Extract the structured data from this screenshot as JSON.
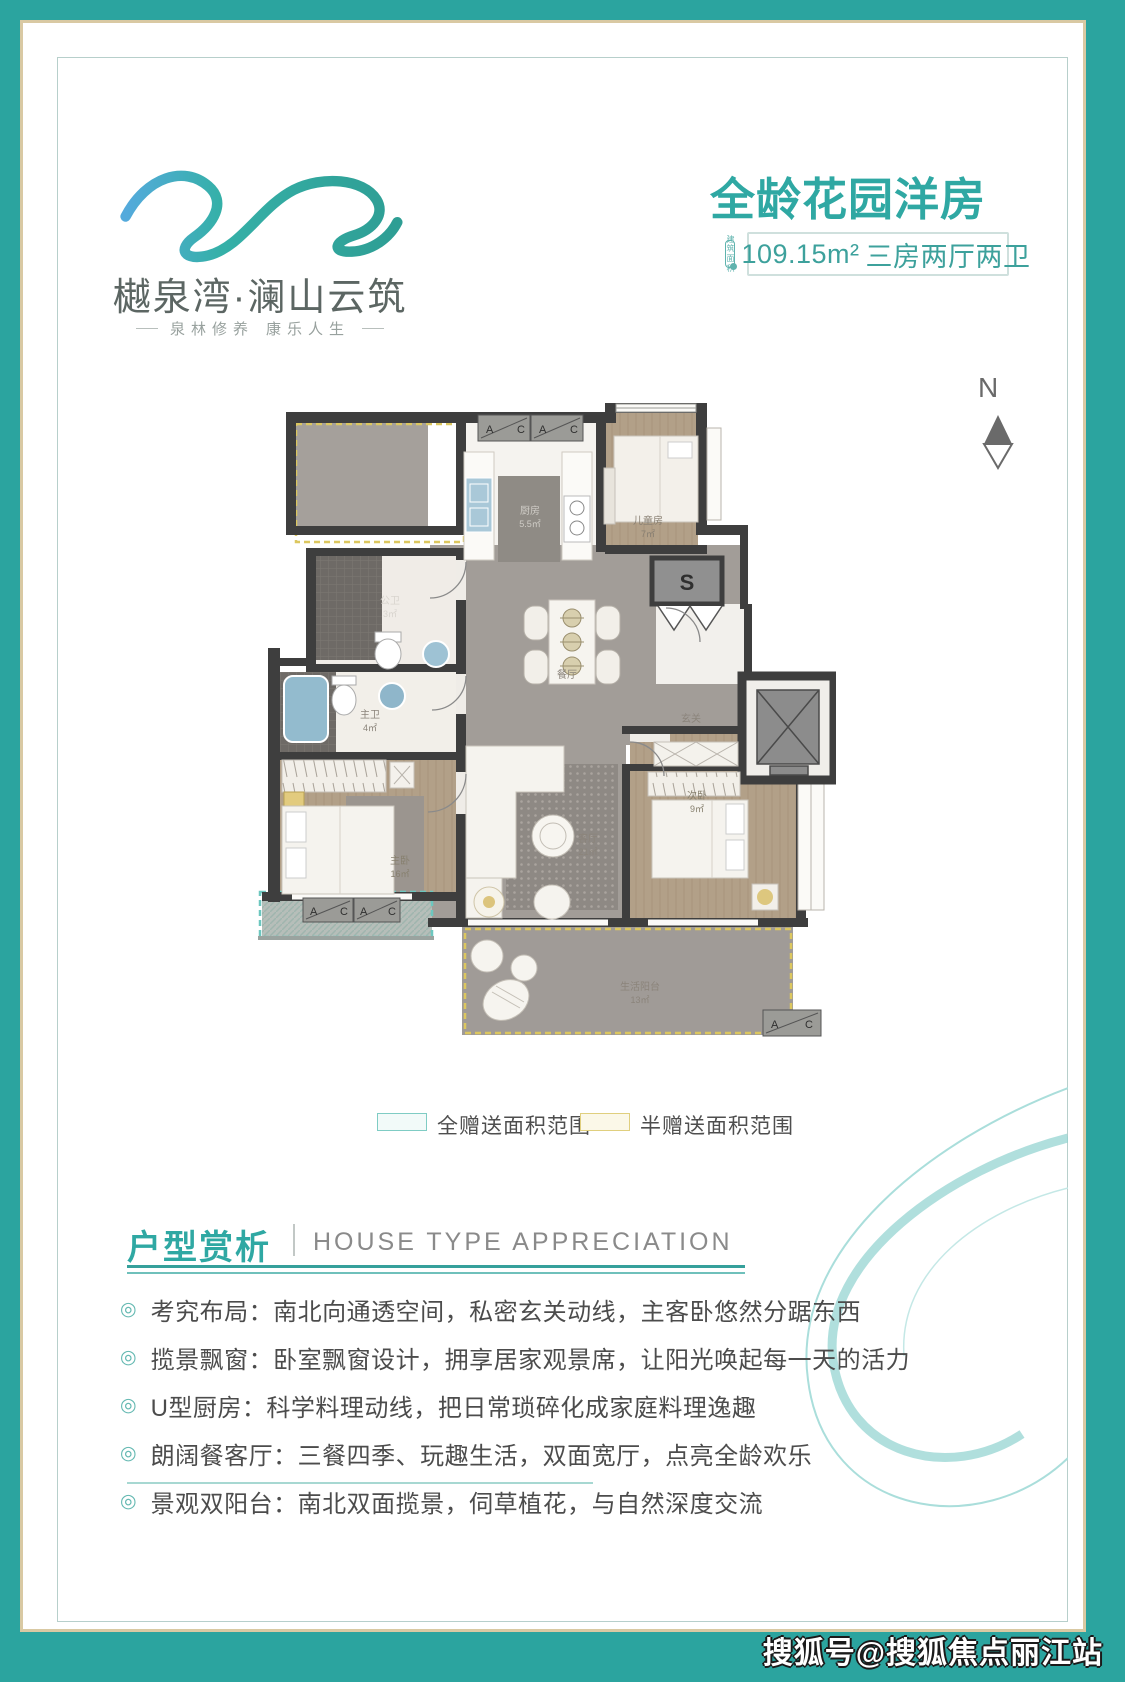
{
  "logo": {
    "brand": "樾泉湾·澜山云筑",
    "tagline_left": "泉林修养",
    "tagline_right": "康乐人生"
  },
  "header": {
    "title": "全龄花园洋房",
    "badge": {
      "icon_line1": "建筑",
      "icon_line2": "面积",
      "area": "109.15m²",
      "layout": "三房两厅两卫"
    }
  },
  "compass": {
    "label": "N"
  },
  "floorplan": {
    "stair_label": "S",
    "ac_letters": {
      "a": "A",
      "c": "C"
    },
    "rooms": [
      {
        "name": "厨房",
        "area": "5.5㎡"
      },
      {
        "name": "儿童房",
        "area": "7㎡"
      },
      {
        "name": "餐厅",
        "area": ""
      },
      {
        "name": "公卫",
        "area": "3㎡"
      },
      {
        "name": "主卫",
        "area": "4㎡"
      },
      {
        "name": "主卧",
        "area": "16㎡"
      },
      {
        "name": "客厅",
        "area": "21㎡"
      },
      {
        "name": "次卧",
        "area": "9㎡"
      },
      {
        "name": "生活阳台",
        "area": "13㎡"
      },
      {
        "name": "玄关",
        "area": ""
      }
    ]
  },
  "legend": {
    "full_gift": {
      "label": "全赠送面积范围",
      "border": "#7fccc4",
      "fill": "#f2faf9"
    },
    "half_gift": {
      "label": "半赠送面积范围",
      "border": "#e0cf7e",
      "fill": "#fbf8e8"
    }
  },
  "section": {
    "title_cn": "户型赏析",
    "title_en": "HOUSE TYPE APPRECIATION"
  },
  "features": [
    "考究布局：南北向通透空间，私密玄关动线，主客卧悠然分踞东西",
    "揽景飘窗：卧室飘窗设计，拥享居家观景席，让阳光唤起每一天的活力",
    "U型厨房：科学料理动线，把日常琐碎化成家庭料理逸趣",
    "朗阔餐客厅：三餐四季、玩趣生活，双面宽厅，点亮全龄欢乐",
    "景观双阳台：南北双面揽景，伺草植花，与自然深度交流"
  ],
  "watermark": "搜狐号@搜狐焦点丽江站",
  "colors": {
    "frame_teal": "#2ba49f",
    "frame_gold": "#d9c9a3",
    "accent_teal": "#2fa8a3",
    "wall": "#3e3e3e",
    "full_gift_dash": "#6cc7bf",
    "half_gift_dash": "#dcc75f"
  }
}
